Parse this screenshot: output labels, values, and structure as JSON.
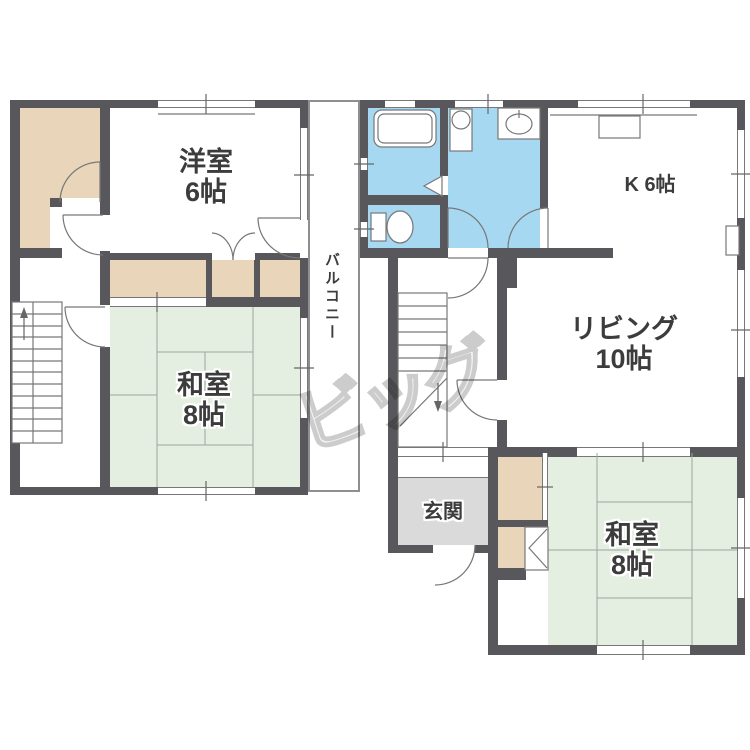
{
  "upper_floor": {
    "western_room": {
      "name": "洋室",
      "size": "6帖"
    },
    "japanese_room": {
      "name": "和室",
      "size": "8帖"
    },
    "balcony": {
      "name": "バルコニー"
    }
  },
  "lower_floor": {
    "kitchen": {
      "name": "K 6帖"
    },
    "living": {
      "name": "リビング",
      "size": "10帖"
    },
    "japanese_room": {
      "name": "和室",
      "size": "8帖"
    },
    "entrance": {
      "name": "玄関"
    }
  },
  "watermark": {
    "text": "ビッグ"
  },
  "colors": {
    "wall": "#58585c",
    "tatami": "#e4efe1",
    "tatami_line": "#9aa79b",
    "closet": "#e8d5ba",
    "wet_area": "#a6d8f2",
    "entrance_floor": "#dadada",
    "line": "#777777",
    "text": "#3c3c3c"
  },
  "icons": {
    "bathtub": "bathtub-icon",
    "toilet": "toilet-icon",
    "wash_basin": "wash-basin-icon",
    "washing_machine": "washing-machine-pan-icon",
    "kitchen_counter": "kitchen-counter-icon",
    "stairs_up": "stairs-up-arrow-icon",
    "stairs_down": "stairs-down-arrow-icon",
    "folding_door": "folding-door-icon"
  }
}
